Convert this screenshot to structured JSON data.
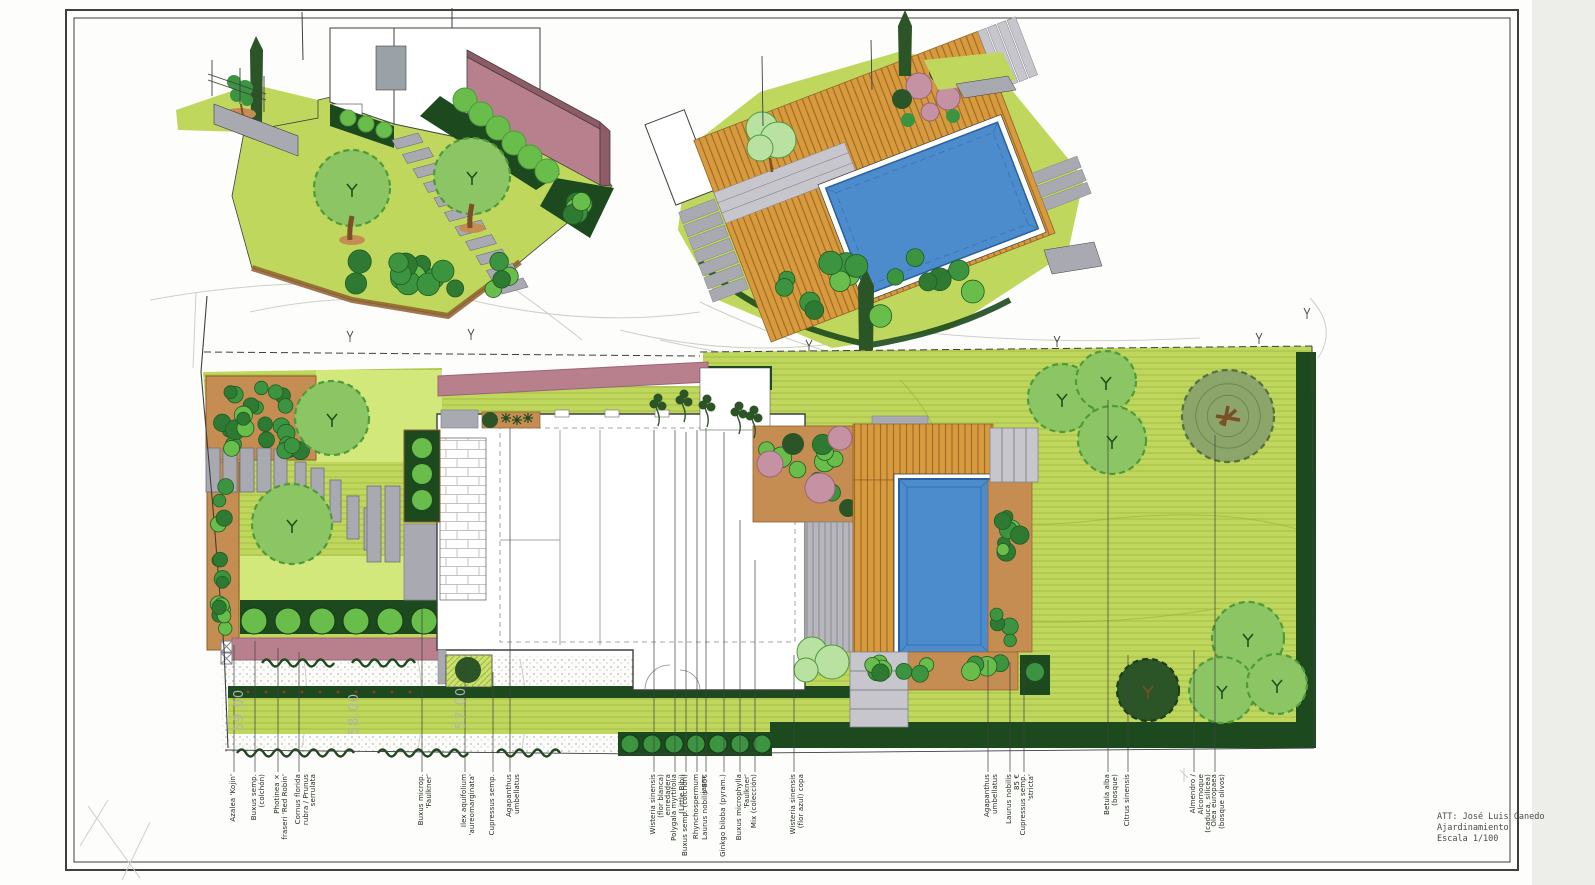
{
  "sheet": {
    "attribution": {
      "line1": "ATT: José Luis Canedo",
      "line2": "Ajardinamiento",
      "line3": "Escala 1/100"
    }
  },
  "palette": {
    "ink": "#3f3f3f",
    "faint": "#cfcfc8",
    "grass": "#bfd75d",
    "grassLine": "#8fae2e",
    "lawnBright": "#d3e87a",
    "hedge": "#1c4a1e",
    "shrub": "#3c9440",
    "shrubLight": "#69bd4b",
    "shrubPale": "#b9e2a2",
    "soil": "#c68d52",
    "soilEdge": "#8f5f2e",
    "stone": "#a9a9b1",
    "stoneLight": "#c6c6cc",
    "deck": "#d79a3e",
    "deckLine": "#a06b22",
    "pool": "#4c8ccc",
    "poolEdge": "#2b5f9e",
    "wallPink": "#b8808c",
    "wallPinkDark": "#8f5b66",
    "treeLight": "#8cc563",
    "treeMid": "#4e9a3c",
    "treeOlive": "#8ba56b",
    "treeDark": "#2c5527",
    "trunk": "#7b4f27",
    "pink": "#c492a2",
    "pinkDark": "#9b6478"
  },
  "plan": {
    "contour_labels": [
      {
        "text": "59.00",
        "x": 243,
        "y": 710
      },
      {
        "text": "58.00",
        "x": 358,
        "y": 714
      },
      {
        "text": "57.00",
        "x": 465,
        "y": 708
      }
    ],
    "plant_labels": [
      {
        "x": 232,
        "leader_top": 645,
        "text": "Azalea 'Kojin'"
      },
      {
        "x": 253,
        "leader_top": 641,
        "text": "Buxus semp.\n(colchón)"
      },
      {
        "x": 276,
        "leader_top": 648,
        "text": "Photinea ×\nfraseri 'Red Robin'"
      },
      {
        "x": 297,
        "leader_top": 652,
        "text": "Cornus florida\nrubra / Prunus\nserrulata"
      },
      {
        "x": 420,
        "leader_top": 606,
        "text": "Buxus microp.\n'Faulkner'"
      },
      {
        "x": 463,
        "leader_top": 660,
        "text": "Ilex aquifolium\n'aureomarginata'"
      },
      {
        "x": 491,
        "leader_top": 672,
        "text": "Cupressus semp."
      },
      {
        "x": 508,
        "leader_top": 428,
        "text": "Agapanthus\numbellatus"
      },
      {
        "x": 652,
        "leader_top": 430,
        "text": "Wisteria sinensis\n(flor blanca) enredadera"
      },
      {
        "x": 673,
        "leader_top": 430,
        "text": "Polygala myrtifolia\n(Little Bibi)"
      },
      {
        "x": 684,
        "leader_top": 432,
        "text": "Buxus semp. (colchón)"
      },
      {
        "x": 695,
        "leader_top": 430,
        "text": "Rhynchospermum jasm."
      },
      {
        "x": 704,
        "leader_top": 428,
        "text": "Laurus nobilis 85€"
      },
      {
        "x": 722,
        "leader_top": 432,
        "text": "Ginkgo biloba (pyram.)"
      },
      {
        "x": 738,
        "leader_top": 520,
        "text": "Buxus microphylla\n'Faulkner'"
      },
      {
        "x": 753,
        "leader_top": 560,
        "text": "Mix (colección)"
      },
      {
        "x": 792,
        "leader_top": 655,
        "text": "Wisteria sinensis\n(flor azul) copa"
      },
      {
        "x": 986,
        "leader_top": 660,
        "text": "Agapanthus\numbellatus"
      },
      {
        "x": 1008,
        "leader_top": 662,
        "text": "Laurus nobilis\n85 €"
      },
      {
        "x": 1022,
        "leader_top": 664,
        "text": "Cupressus semp.\n'stricta'"
      },
      {
        "x": 1106,
        "leader_top": 400,
        "text": "Betula alba\n(bosque)"
      },
      {
        "x": 1126,
        "leader_top": 655,
        "text": "Citrus sinensis"
      },
      {
        "x": 1192,
        "leader_top": 650,
        "text": "Almendro /\nAlcornoque\n(caduca, silícea)"
      },
      {
        "x": 1213,
        "leader_top": 435,
        "text": "Olea europaea\n(bosque olivos)"
      }
    ]
  }
}
